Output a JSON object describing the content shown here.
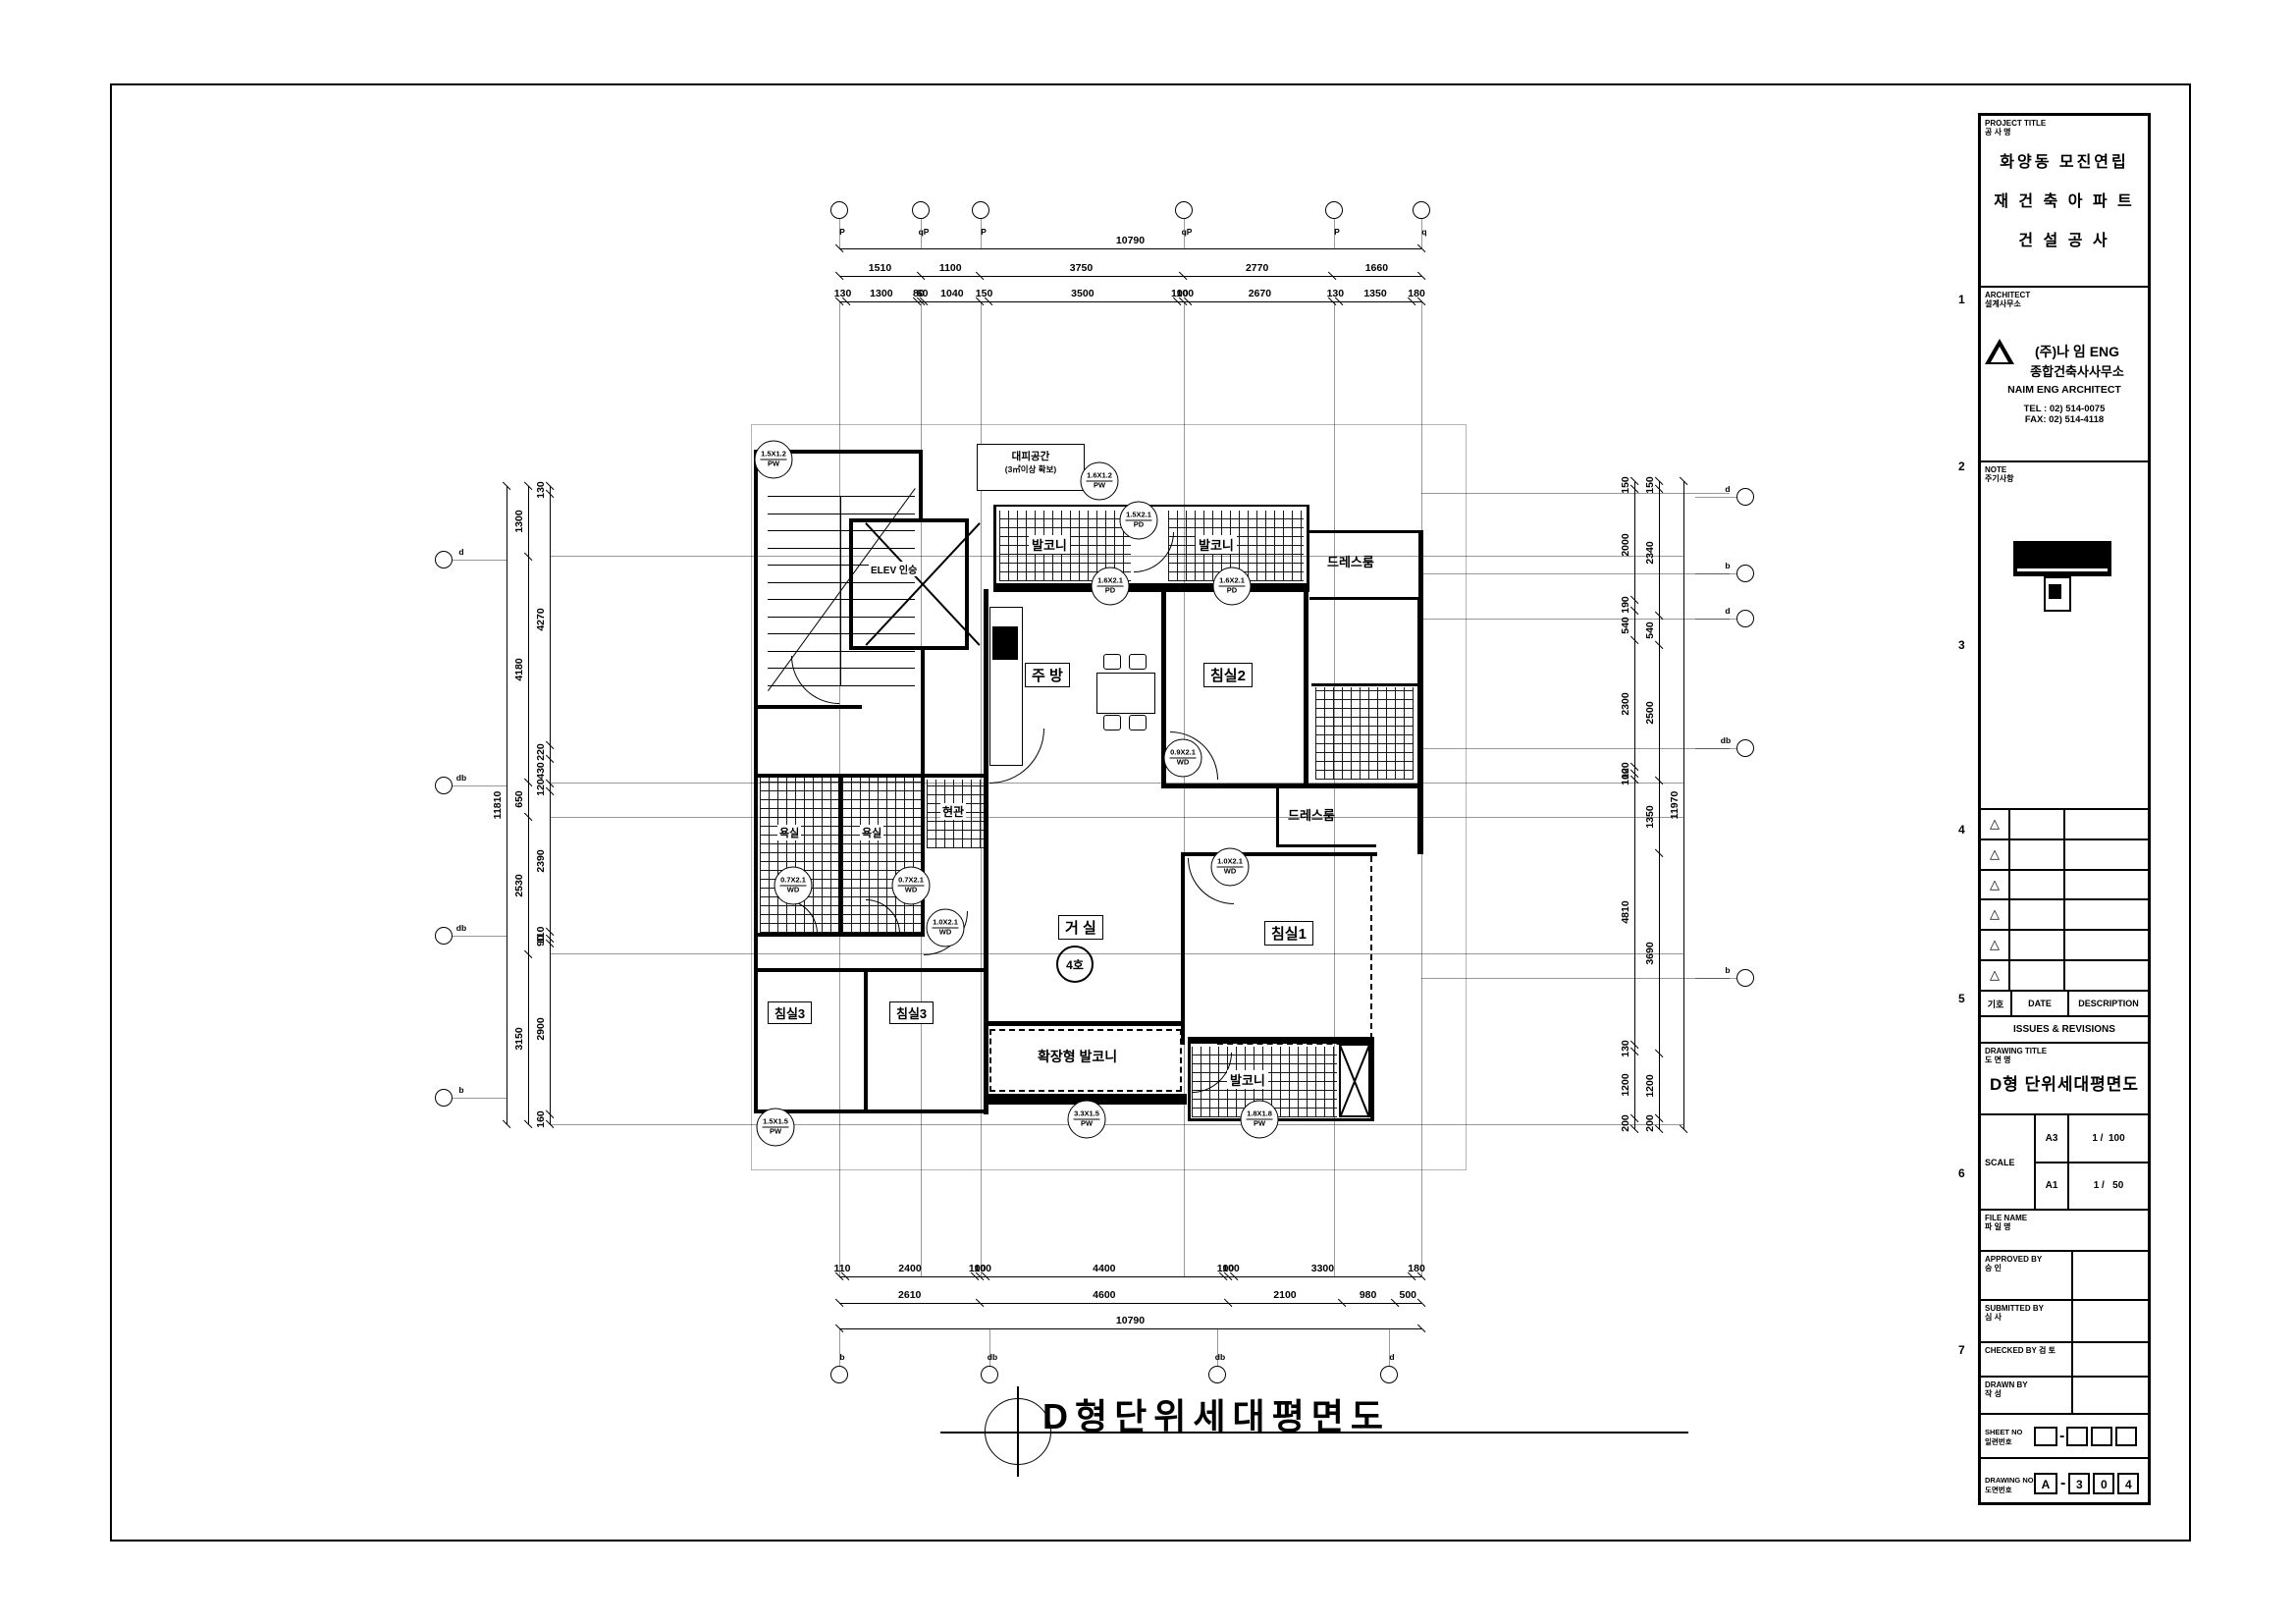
{
  "title_block": {
    "project_title_label": "PROJECT TITLE",
    "project_title_label_kr": "공 사 명",
    "project_lines": [
      "화양동 모진연립",
      "재 건 축 아 파 트",
      "건  설  공  사"
    ],
    "architect_label": "ARCHITECT",
    "architect_label_kr": "설계사무소",
    "architect_name_line1": "(주)나 임  ENG",
    "architect_name_line2": "종합건축사사무소",
    "architect_name_en": "NAIM ENG ARCHITECT",
    "tel": "TEL : 02) 514-0075",
    "fax": "FAX: 02) 514-4118",
    "note_label": "NOTE",
    "note_label_kr": "주기사항",
    "revisions": {
      "rows": 6,
      "col_symbol": "기호",
      "col_date": "DATE",
      "col_desc": "DESCRIPTION",
      "footer": "ISSUES & REVISIONS",
      "triangle": "△"
    },
    "drawing_title_label": "DRAWING TITLE",
    "drawing_title_label_kr": "도 면 명",
    "drawing_title": "D형 단위세대평면도",
    "scale_label": "SCALE",
    "scales": [
      {
        "sheet": "A3",
        "ratio": "1 /  100"
      },
      {
        "sheet": "A1",
        "ratio": "1 /   50"
      }
    ],
    "file_name_label": "FILE NAME",
    "file_name_label_kr": "파 일 명",
    "approved_label": "APPROVED BY",
    "approved_label_kr": "승 인",
    "submitted_label": "SUBMITTED BY",
    "submitted_label_kr": "심 사",
    "checked_label": "CHECKED BY",
    "checked_label_kr": "검 토",
    "drawn_label": "DRAWN BY",
    "drawn_label_kr": "작 성",
    "sheet_no_label": "SHEET NO",
    "sheet_no_label_kr": "일련번호",
    "drawing_no_label": "DRAWING NO",
    "drawing_no_label_kr": "도면번호",
    "drawing_no": [
      "A",
      "3",
      "0",
      "4"
    ],
    "drawing_no_dash": "-"
  },
  "zone_numbers": [
    "1",
    "2",
    "3",
    "4",
    "5",
    "6",
    "7"
  ],
  "plan": {
    "caption": "D형단위세대평면도",
    "rooms": {
      "kitchen": "주 방",
      "bedroom2": "침실2",
      "bedroom1": "침실1",
      "bedroom3a": "침실3",
      "bedroom3b": "침실3",
      "living": "거 실",
      "unit_no": "4호",
      "dress_top": "드레스룸",
      "dress_mid": "드레스룸",
      "bath1": "욕실",
      "bath2": "욕실",
      "entrance": "현관",
      "balcony_top1": "발코니",
      "balcony_top2": "발코니",
      "balcony_bottom": "발코니",
      "ext_balcony": "확장형 발코니",
      "elevator": "ELEV 인승",
      "evac_line1": "대피공간",
      "evac_line2": "(3㎡이상 확보)"
    },
    "tags": [
      {
        "size": "1.5X1.2",
        "code": "PW"
      },
      {
        "size": "1.6X1.2",
        "code": "PW"
      },
      {
        "size": "1.5X2.1",
        "code": "PD"
      },
      {
        "size": "1.6X2.1",
        "code": "PD"
      },
      {
        "size": "1.6X2.1",
        "code": "PD"
      },
      {
        "size": "0.9X2.1",
        "code": "WD"
      },
      {
        "size": "0.7X2.1",
        "code": "WD"
      },
      {
        "size": "0.7X2.1",
        "code": "WD"
      },
      {
        "size": "1.0X2.1",
        "code": "WD"
      },
      {
        "size": "1.0X2.1",
        "code": "WD"
      },
      {
        "size": "3.3X1.5",
        "code": "PW"
      },
      {
        "size": "1.8X1.8",
        "code": "PW"
      },
      {
        "size": "1.5X1.5",
        "code": "PW"
      }
    ]
  },
  "dimensions": {
    "top": {
      "total": [
        "10790"
      ],
      "row2": [
        "1510",
        "1100",
        "3750",
        "2770",
        "1660"
      ],
      "row3": [
        "130",
        "1300",
        "80",
        "60",
        "1040",
        "150",
        "3500",
        "100",
        "100",
        "2670",
        "130",
        "1350",
        "180"
      ]
    },
    "bottom": {
      "row1": [
        "110",
        "2400",
        "100",
        "100",
        "4400",
        "100",
        "100",
        "3300",
        "180"
      ],
      "row2": [
        "2610",
        "4600",
        "2100",
        "980",
        "500"
      ],
      "total": [
        "10790"
      ]
    },
    "left": {
      "total": [
        "11810"
      ],
      "mid": [
        "1300",
        "4180",
        "650",
        "2530",
        "3150"
      ],
      "inner": [
        "130",
        "4270",
        "220",
        "430",
        "120",
        "2390",
        "110",
        "90",
        "2900",
        "160"
      ]
    },
    "right": {
      "inner": [
        "150",
        "2000",
        "190",
        "540",
        "2300",
        "120",
        "100",
        "4810",
        "130",
        "1200",
        "200"
      ],
      "mid": [
        "150",
        "2340",
        "540",
        "2500",
        "1350",
        "3690",
        "1200",
        "200"
      ],
      "total": [
        "11970"
      ]
    }
  },
  "grid_bubbles": {
    "top": [
      "P",
      "qP",
      "P",
      "qP",
      "P",
      "q"
    ],
    "bottom": [
      "b",
      "db",
      "db",
      "d"
    ],
    "left": [
      "d",
      "db",
      "db",
      "b"
    ],
    "right": [
      "d",
      "b",
      "d",
      "db",
      "b"
    ]
  }
}
